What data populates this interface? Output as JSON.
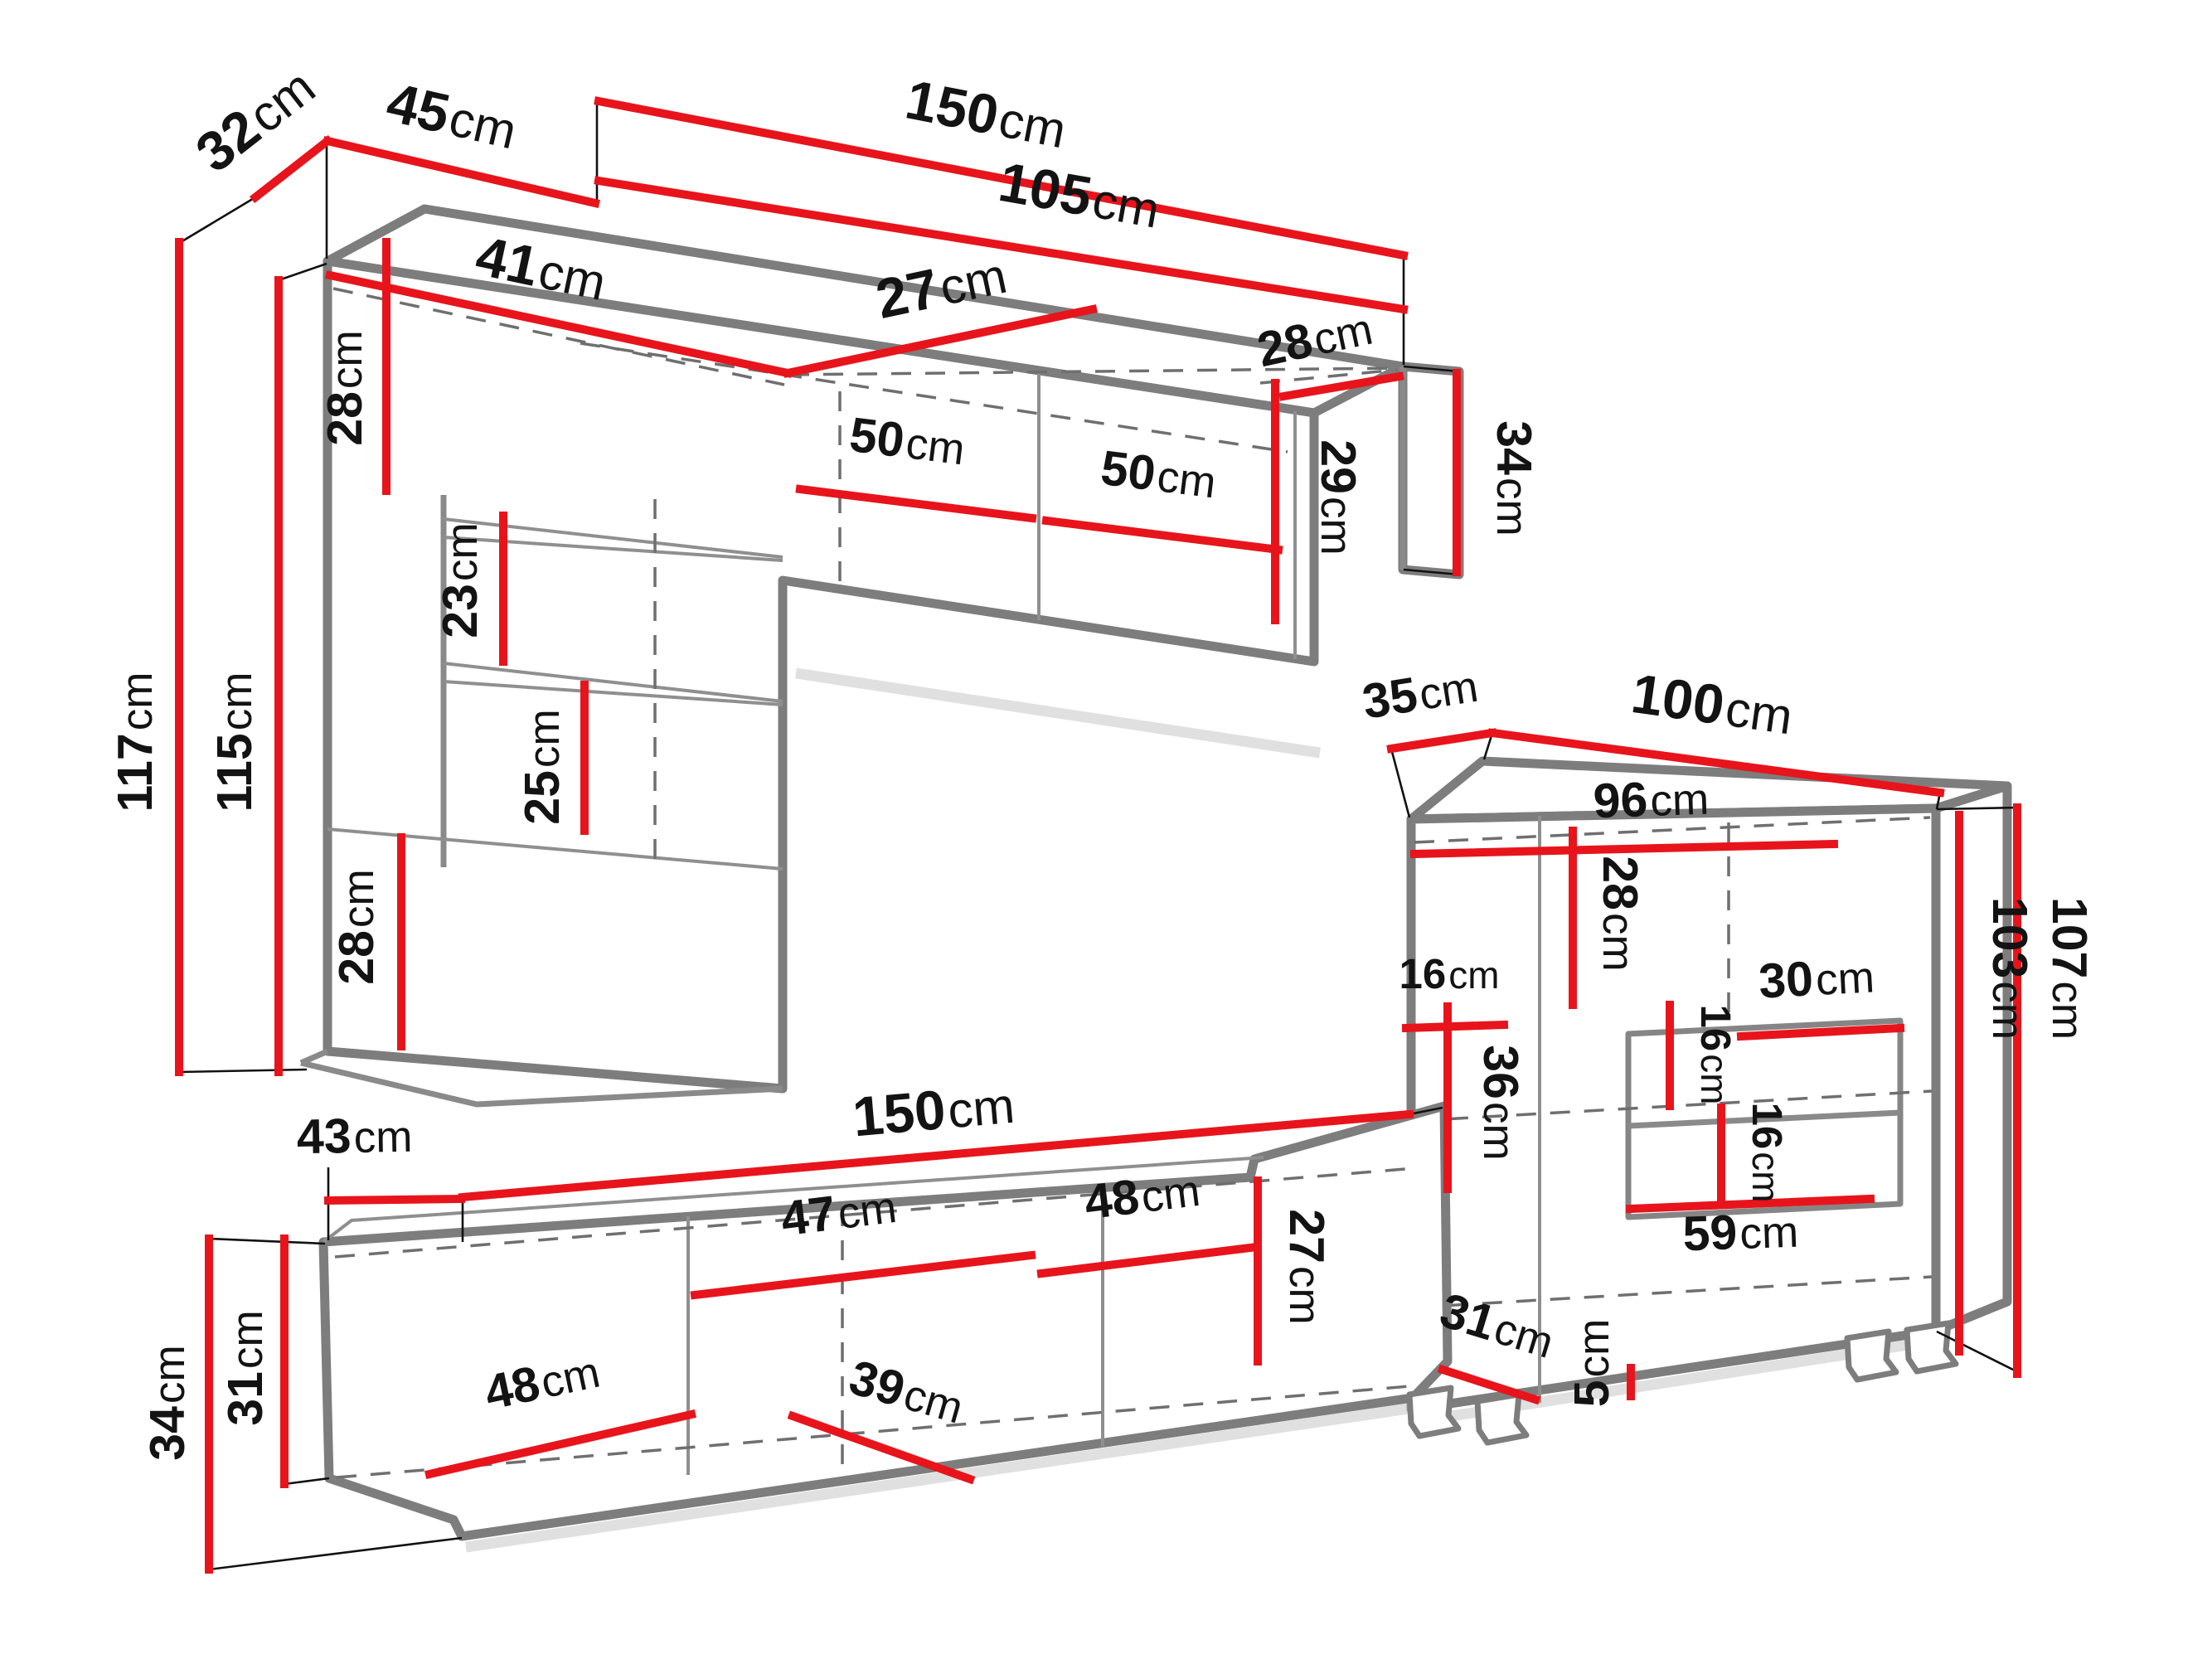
{
  "diagram": {
    "unit": "cm",
    "accent_color": "#e8141c",
    "outline_color": "#7d7d7d",
    "label_color": "#131313",
    "background_color": "#ffffff"
  },
  "labels": {
    "top_unit": {
      "depth_top": {
        "value": "32",
        "unit": "cm"
      },
      "column_width": {
        "value": "45",
        "unit": "cm"
      },
      "total_width": {
        "value": "150",
        "unit": "cm"
      },
      "right_width": {
        "value": "105",
        "unit": "cm"
      },
      "top_inner_left": {
        "value": "41",
        "unit": "cm"
      },
      "top_inner_right": {
        "value": "27",
        "unit": "cm"
      },
      "column_top_section": {
        "value": "28",
        "unit": "cm"
      },
      "shelf_gap_upper": {
        "value": "23",
        "unit": "cm"
      },
      "shelf_gap_lower": {
        "value": "25",
        "unit": "cm"
      },
      "column_bottom_section": {
        "value": "28",
        "unit": "cm"
      },
      "height_total": {
        "value": "117",
        "unit": "cm"
      },
      "height_inner": {
        "value": "115",
        "unit": "cm"
      },
      "door_left": {
        "value": "50",
        "unit": "cm"
      },
      "door_right": {
        "value": "50",
        "unit": "cm"
      },
      "end_depth": {
        "value": "28",
        "unit": "cm"
      },
      "end_inner_height": {
        "value": "29",
        "unit": "cm"
      },
      "end_height": {
        "value": "34",
        "unit": "cm"
      }
    },
    "tv_stand": {
      "end_depth": {
        "value": "43",
        "unit": "cm"
      },
      "width": {
        "value": "150",
        "unit": "cm"
      },
      "height_total": {
        "value": "34",
        "unit": "cm"
      },
      "height_body": {
        "value": "31",
        "unit": "cm"
      },
      "compartment_left": {
        "value": "48",
        "unit": "cm"
      },
      "compartment_middle": {
        "value": "47",
        "unit": "cm"
      },
      "shelf_depth": {
        "value": "39",
        "unit": "cm"
      },
      "compartment_right": {
        "value": "48",
        "unit": "cm"
      },
      "inner_height": {
        "value": "27",
        "unit": "cm"
      }
    },
    "right_cabinet": {
      "depth": {
        "value": "35",
        "unit": "cm"
      },
      "width": {
        "value": "100",
        "unit": "cm"
      },
      "inner_width": {
        "value": "96",
        "unit": "cm"
      },
      "top_inner_height": {
        "value": "28",
        "unit": "cm"
      },
      "left_offset": {
        "value": "16",
        "unit": "cm"
      },
      "left_inner_height": {
        "value": "36",
        "unit": "cm"
      },
      "niche_width": {
        "value": "30",
        "unit": "cm"
      },
      "niche_upper_height": {
        "value": "16",
        "unit": "cm"
      },
      "niche_lower_height": {
        "value": "16",
        "unit": "cm"
      },
      "niche_bottom_width": {
        "value": "59",
        "unit": "cm"
      },
      "height_total": {
        "value": "107",
        "unit": "cm"
      },
      "height_inner": {
        "value": "103",
        "unit": "cm"
      },
      "bottom_depth": {
        "value": "31",
        "unit": "cm"
      },
      "leg_height": {
        "value": "5",
        "unit": "cm"
      }
    }
  }
}
